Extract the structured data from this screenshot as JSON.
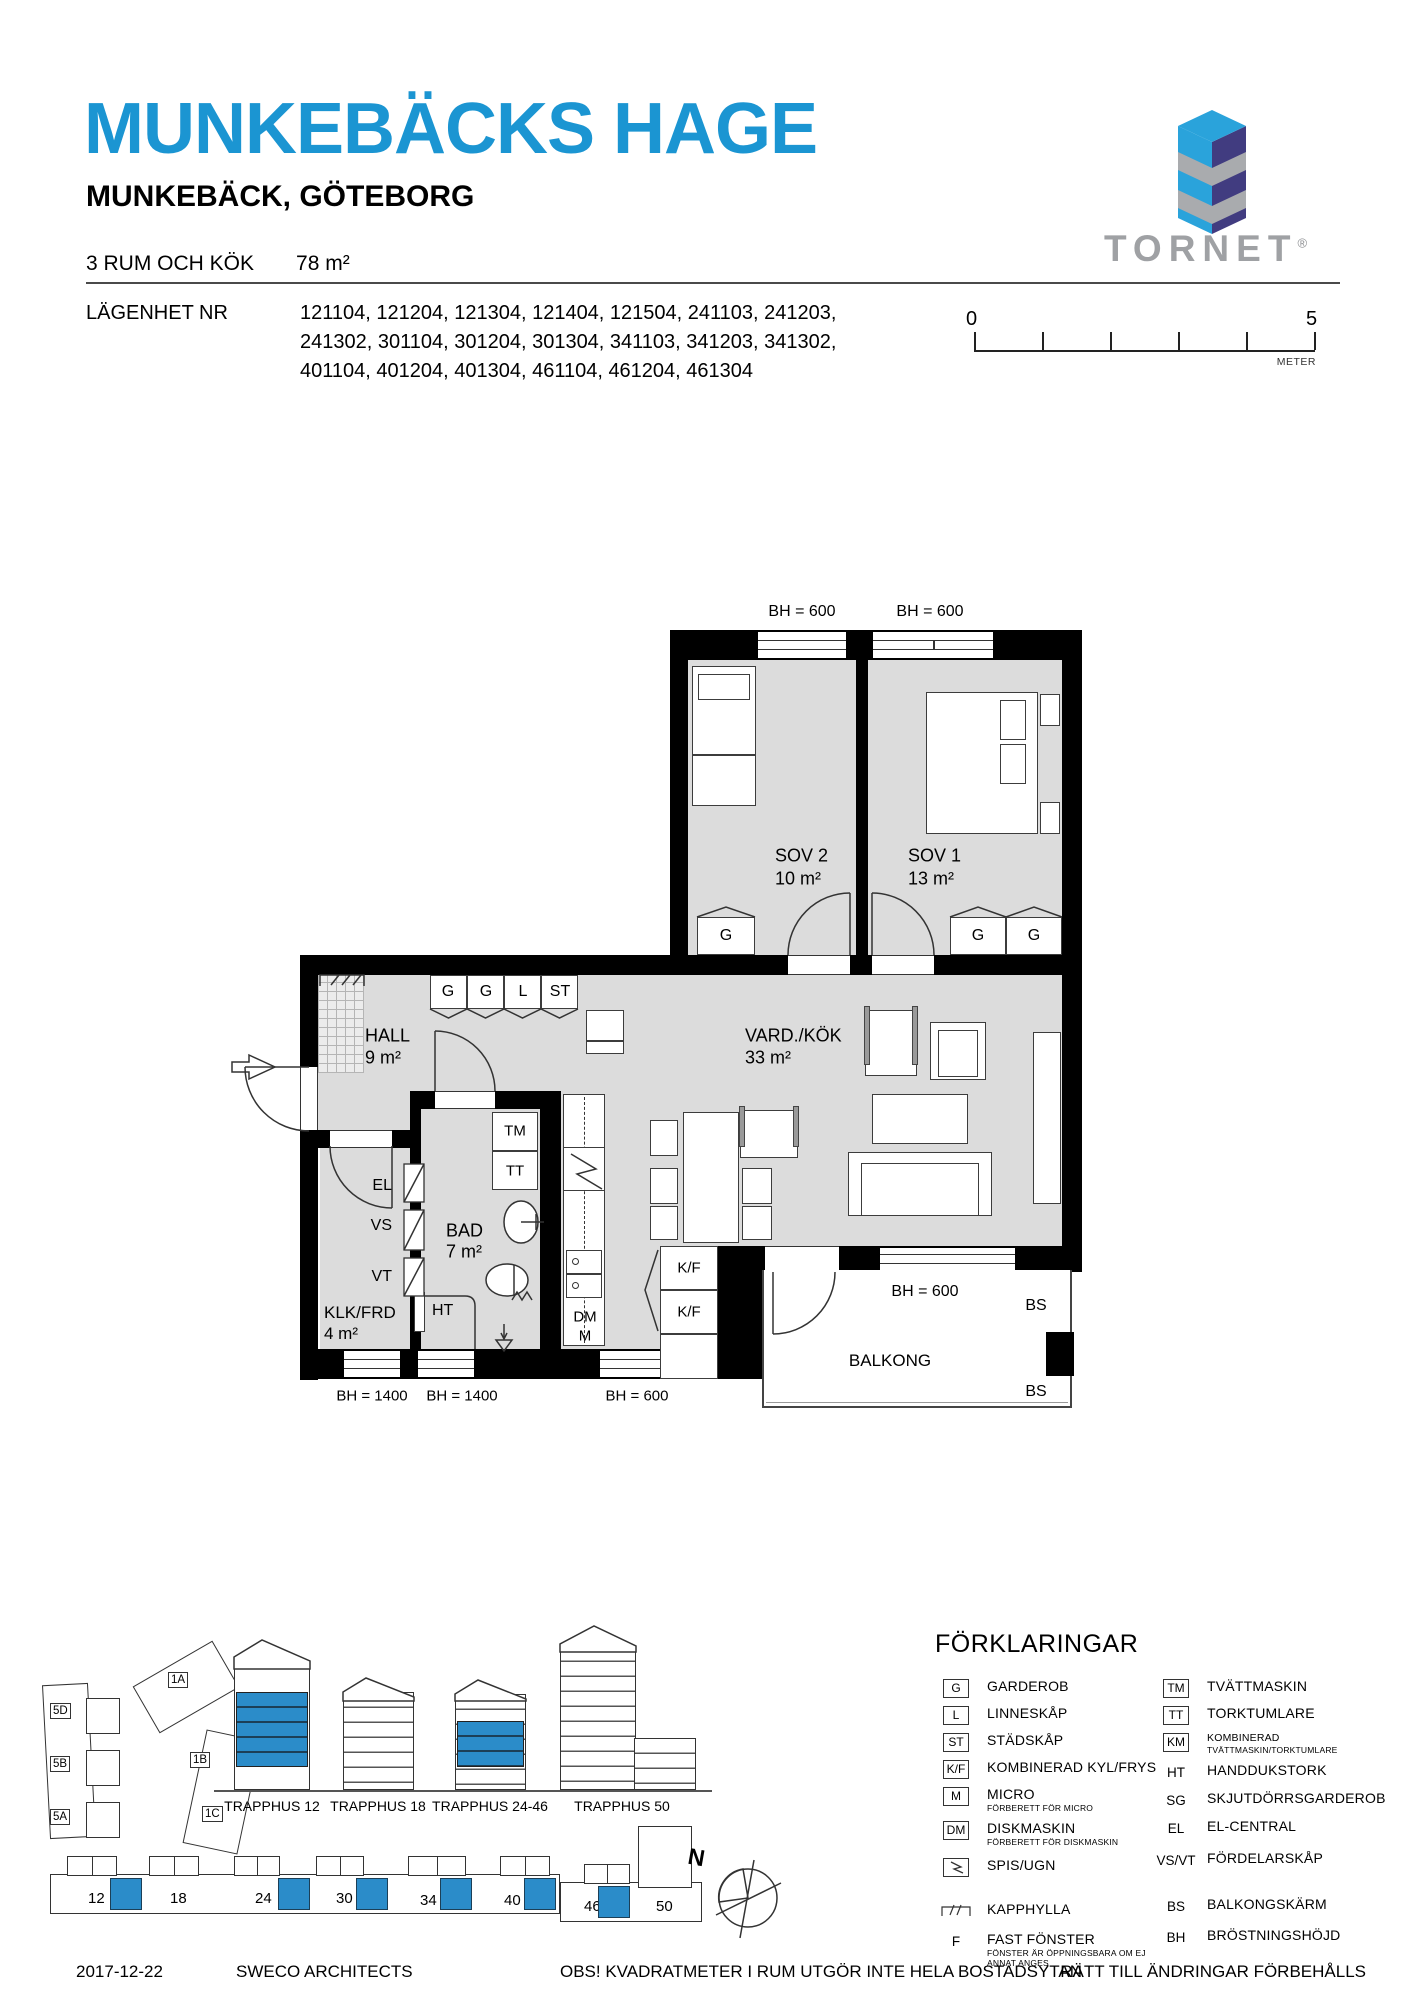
{
  "header": {
    "title": "MUNKEBÄCKS HAGE",
    "subtitle": "MUNKEBÄCK, GÖTEBORG",
    "apartment_type": "3 RUM OCH KÖK",
    "area": "78 m²",
    "apartment_label": "LÄGENHET NR",
    "apartment_numbers_line1": "121104, 121204, 121304, 121404, 121504, 241103, 241203,",
    "apartment_numbers_line2": "241302, 301104, 301204, 301304, 341103, 341203, 341302,",
    "apartment_numbers_line3": "401104, 401204, 401304, 461104, 461204, 461304",
    "brand": "TORNET",
    "brand_registered": "®"
  },
  "scale_bar": {
    "start": "0",
    "end": "5",
    "unit": "METER"
  },
  "colors": {
    "accent_blue": "#1b95d2",
    "logo_light_blue": "#2aa3db",
    "logo_navy": "#413c80",
    "logo_gray": "#a9abae",
    "floor_gray": "#dcdcdc",
    "site_blue": "#2b8cc9"
  },
  "plan": {
    "labels": [
      {
        "t": "BH = 600",
        "x": 802,
        "y": 612,
        "fs": 16
      },
      {
        "t": "BH = 600",
        "x": 930,
        "y": 612,
        "fs": 16
      },
      {
        "t": "SOV 2",
        "x": 775,
        "y": 856,
        "a": "l",
        "fs": 18
      },
      {
        "t": "10 m²",
        "x": 775,
        "y": 879,
        "a": "l",
        "fs": 18
      },
      {
        "t": "SOV 1",
        "x": 908,
        "y": 856,
        "a": "l",
        "fs": 18
      },
      {
        "t": "13 m²",
        "x": 908,
        "y": 879,
        "a": "l",
        "fs": 18
      },
      {
        "t": "G",
        "x": 726,
        "y": 936,
        "fs": 16
      },
      {
        "t": "G",
        "x": 978,
        "y": 936,
        "fs": 16
      },
      {
        "t": "G",
        "x": 1034,
        "y": 936,
        "fs": 16
      },
      {
        "t": "G",
        "x": 448,
        "y": 992,
        "fs": 16
      },
      {
        "t": "G",
        "x": 486,
        "y": 992,
        "fs": 16
      },
      {
        "t": "L",
        "x": 523,
        "y": 992,
        "fs": 16
      },
      {
        "t": "ST",
        "x": 560,
        "y": 992,
        "fs": 16
      },
      {
        "t": "HALL",
        "x": 365,
        "y": 1036,
        "a": "l",
        "fs": 18
      },
      {
        "t": "9 m²",
        "x": 365,
        "y": 1058,
        "a": "l",
        "fs": 18
      },
      {
        "t": "VARD./KÖK",
        "x": 745,
        "y": 1036,
        "a": "l",
        "fs": 18
      },
      {
        "t": "33 m²",
        "x": 745,
        "y": 1058,
        "a": "l",
        "fs": 18
      },
      {
        "t": "TM",
        "x": 515,
        "y": 1131,
        "fs": 15
      },
      {
        "t": "TT",
        "x": 515,
        "y": 1171,
        "fs": 15
      },
      {
        "t": "EL",
        "x": 392,
        "y": 1186,
        "a": "r",
        "fs": 16
      },
      {
        "t": "VS",
        "x": 392,
        "y": 1226,
        "a": "r",
        "fs": 16
      },
      {
        "t": "VT",
        "x": 392,
        "y": 1277,
        "a": "r",
        "fs": 16
      },
      {
        "t": "BAD",
        "x": 446,
        "y": 1231,
        "a": "l",
        "fs": 18
      },
      {
        "t": "7 m²",
        "x": 446,
        "y": 1252,
        "a": "l",
        "fs": 18
      },
      {
        "t": "HT",
        "x": 432,
        "y": 1311,
        "a": "l",
        "fs": 16
      },
      {
        "t": "KLK/FRD",
        "x": 324,
        "y": 1313,
        "a": "l",
        "fs": 17
      },
      {
        "t": "4 m²",
        "x": 324,
        "y": 1334,
        "a": "l",
        "fs": 17
      },
      {
        "t": "DM",
        "x": 585,
        "y": 1317,
        "fs": 15
      },
      {
        "t": "M",
        "x": 585,
        "y": 1336,
        "fs": 15
      },
      {
        "t": "K/F",
        "x": 689,
        "y": 1268,
        "fs": 15
      },
      {
        "t": "K/F",
        "x": 689,
        "y": 1312,
        "fs": 15
      },
      {
        "t": "BH = 1400",
        "x": 372,
        "y": 1396,
        "fs": 15
      },
      {
        "t": "BH = 1400",
        "x": 462,
        "y": 1396,
        "fs": 15
      },
      {
        "t": "BH = 600",
        "x": 637,
        "y": 1396,
        "fs": 15
      },
      {
        "t": "BH = 600",
        "x": 925,
        "y": 1292,
        "fs": 16
      },
      {
        "t": "BALKONG",
        "x": 890,
        "y": 1361,
        "fs": 17
      },
      {
        "t": "BS",
        "x": 1036,
        "y": 1306,
        "fs": 16
      },
      {
        "t": "BS",
        "x": 1036,
        "y": 1392,
        "fs": 16
      }
    ]
  },
  "site": {
    "compass_n": "N",
    "block_labels": [
      {
        "t": "5D",
        "x": 50,
        "y": 1703
      },
      {
        "t": "5B",
        "x": 50,
        "y": 1756
      },
      {
        "t": "5A",
        "x": 50,
        "y": 1809
      },
      {
        "t": "1A",
        "x": 168,
        "y": 1672
      },
      {
        "t": "1B",
        "x": 190,
        "y": 1752
      },
      {
        "t": "1C",
        "x": 202,
        "y": 1806
      }
    ],
    "elevation_labels": [
      {
        "t": "TRAPPHUS 12",
        "x": 272,
        "y": 1798
      },
      {
        "t": "TRAPPHUS 18",
        "x": 378,
        "y": 1798
      },
      {
        "t": "TRAPPHUS 24-46",
        "x": 490,
        "y": 1798
      },
      {
        "t": "TRAPPHUS 50",
        "x": 622,
        "y": 1798
      }
    ],
    "strip_numbers": [
      {
        "t": "12",
        "x": 88,
        "y": 1890
      },
      {
        "t": "18",
        "x": 170,
        "y": 1890
      },
      {
        "t": "24",
        "x": 255,
        "y": 1890
      },
      {
        "t": "30",
        "x": 336,
        "y": 1890
      },
      {
        "t": "34",
        "x": 420,
        "y": 1892
      },
      {
        "t": "40",
        "x": 504,
        "y": 1892
      },
      {
        "t": "46",
        "x": 584,
        "y": 1898
      },
      {
        "t": "50",
        "x": 656,
        "y": 1898
      }
    ],
    "blue_cells": [
      {
        "x": 110,
        "y": 1878
      },
      {
        "x": 278,
        "y": 1878
      },
      {
        "x": 356,
        "y": 1878
      },
      {
        "x": 440,
        "y": 1878
      },
      {
        "x": 524,
        "y": 1878
      },
      {
        "x": 598,
        "y": 1886
      }
    ]
  },
  "legend": {
    "title": "FÖRKLARINGAR",
    "left": [
      {
        "symbol": "G",
        "boxed": true,
        "label": "GARDEROB",
        "mt": 0
      },
      {
        "symbol": "L",
        "boxed": true,
        "label": "LINNESKÅP",
        "mt": 7
      },
      {
        "symbol": "ST",
        "boxed": true,
        "label": "STÄDSKÅP",
        "mt": 7
      },
      {
        "symbol": "K/F",
        "boxed": true,
        "label": "KOMBINERAD KYL/FRYS",
        "mt": 7
      },
      {
        "symbol": "M",
        "boxed": true,
        "label": "MICRO",
        "sublabel": "FÖRBERETT FÖR MICRO",
        "mt": 6
      },
      {
        "symbol": "DM",
        "boxed": true,
        "label": "DISKMASKIN",
        "sublabel": "FÖRBERETT FÖR DISKMASKIN",
        "mt": 4
      },
      {
        "symbol": "",
        "icon": "spis",
        "label": "SPIS/UGN",
        "mt": 10
      },
      {
        "symbol": "",
        "icon": "kapphylla",
        "label": "KAPPHYLLA",
        "mt": 24
      },
      {
        "symbol": "F",
        "boxed": false,
        "label": "FAST FÖNSTER",
        "sublabel": "FÖNSTER ÄR ÖPPNINGSBARA OM EJ ANNAT ANGES",
        "mt": 10
      }
    ],
    "right": [
      {
        "symbol": "TM",
        "boxed": true,
        "label": "TVÄTTMASKIN",
        "mt": 0
      },
      {
        "symbol": "TT",
        "boxed": true,
        "label": "TORKTUMLARE",
        "mt": 7
      },
      {
        "symbol": "KM",
        "boxed": true,
        "label": "KOMBINERAD",
        "small": true,
        "sublabel": "TVÄTTMASKIN/TORKTUMLARE",
        "mt": 6
      },
      {
        "symbol": "HT",
        "boxed": false,
        "label": "HANDDUKSTORK",
        "mt": 6
      },
      {
        "symbol": "SG",
        "boxed": false,
        "label": "SKJUTDÖRRSGARDEROB",
        "mt": 8
      },
      {
        "symbol": "EL",
        "boxed": false,
        "label": "EL-CENTRAL",
        "mt": 8
      },
      {
        "symbol": "VS/VT",
        "boxed": false,
        "label": "FÖRDELARSKÅP",
        "mt": 12
      },
      {
        "symbol": "BS",
        "boxed": false,
        "label": "BALKONGSKÄRM",
        "mt": 26
      },
      {
        "symbol": "BH",
        "boxed": false,
        "label": "BRÖSTNINGSHÖJD",
        "mt": 11
      }
    ]
  },
  "footer": {
    "date": "2017-12-22",
    "architect": "SWECO ARCHITECTS",
    "note": "OBS! KVADRATMETER I RUM UTGÖR INTE HELA BOSTADSYTAN",
    "rights": "RÄTT TILL ÄNDRINGAR FÖRBEHÅLLS"
  }
}
